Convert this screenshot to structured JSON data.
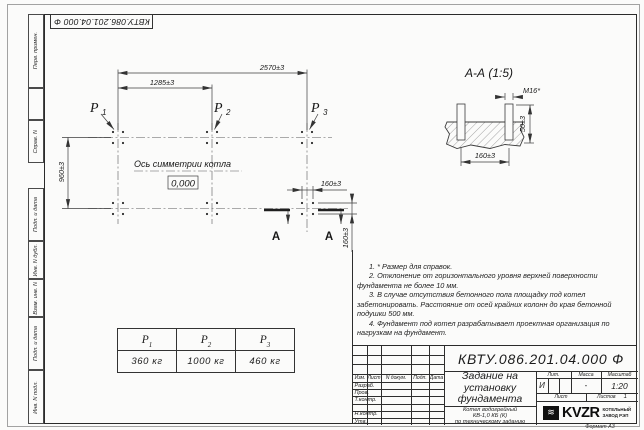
{
  "sheet": {
    "top_stamp": "КВТУ.086.201.04.000 Ф",
    "format_note": "Формат А3"
  },
  "margin": {
    "perv_primen": "Перв. примен.",
    "sprav_n": "Справ. N",
    "podp_data_1": "Подп. и дата",
    "inv_dubl": "Инв. N дубл.",
    "vzam_inv": "Взам. инв. N",
    "podp_data_2": "Подп. и дата",
    "inv_podl": "Инв. N подл."
  },
  "plan": {
    "dim_2570": "2570±3",
    "dim_1285": "1285±3",
    "dim_960": "960±3",
    "dim_160": "160±3",
    "p_letter": "P",
    "p1_sub": "1",
    "p2_sub": "2",
    "p3_sub": "3",
    "axis_label": "Ось симметрии котла",
    "zero_mark": "0,000",
    "section_letter": "А"
  },
  "section_view": {
    "title": "А-А (1:5)",
    "bolt_label": "М16*",
    "dim_50": "50±3",
    "dim_160": "160±3"
  },
  "load_table": {
    "columns": [
      {
        "sym": "P",
        "sub": "1",
        "value": "360 кг"
      },
      {
        "sym": "P",
        "sub": "2",
        "value": "1000 кг"
      },
      {
        "sym": "P",
        "sub": "3",
        "value": "460 кг"
      }
    ]
  },
  "notes": {
    "items": [
      "1. * Размер для справок.",
      "2. Отклонение от горизонтального уровня верхней поверхности фундамента не более 10 мм.",
      "3. В случае отсутствия бетонного пола площадку под котел забетонировать. Расстояние от осей крайних колонн до края бетонной подушки 500 мм.",
      "4. Фундамент под котел разрабатывает проектная организация по нагрузкам на фундамент."
    ]
  },
  "title_block": {
    "doc_number": "КВТУ.086.201.04.000 Ф",
    "doc_title": "Задание на установку фундамента",
    "product_lines": [
      "Котел водогрейный",
      "КВ-1,0 КБ (К)",
      "по техническому заданию"
    ],
    "change_header": [
      "Изм.",
      "Лист",
      "N докум.",
      "Подп.",
      "Дата"
    ],
    "sign_rows": [
      "Разраб.",
      "Пров.",
      "Т.контр.",
      "",
      "Н.контр.",
      "Утв."
    ],
    "lit_label": "Лит.",
    "lit_value": "И",
    "mass_label": "Масса",
    "mass_value": "-",
    "scale_label": "Масштаб",
    "scale_value": "1:20",
    "sheet_label": "Лист",
    "sheets_label": "Листов",
    "sheets_value": "1",
    "logo_name": "KVZR",
    "logo_caption": [
      "КОТЕЛЬНЫЙ",
      "ЗАВОД РЭП"
    ]
  }
}
